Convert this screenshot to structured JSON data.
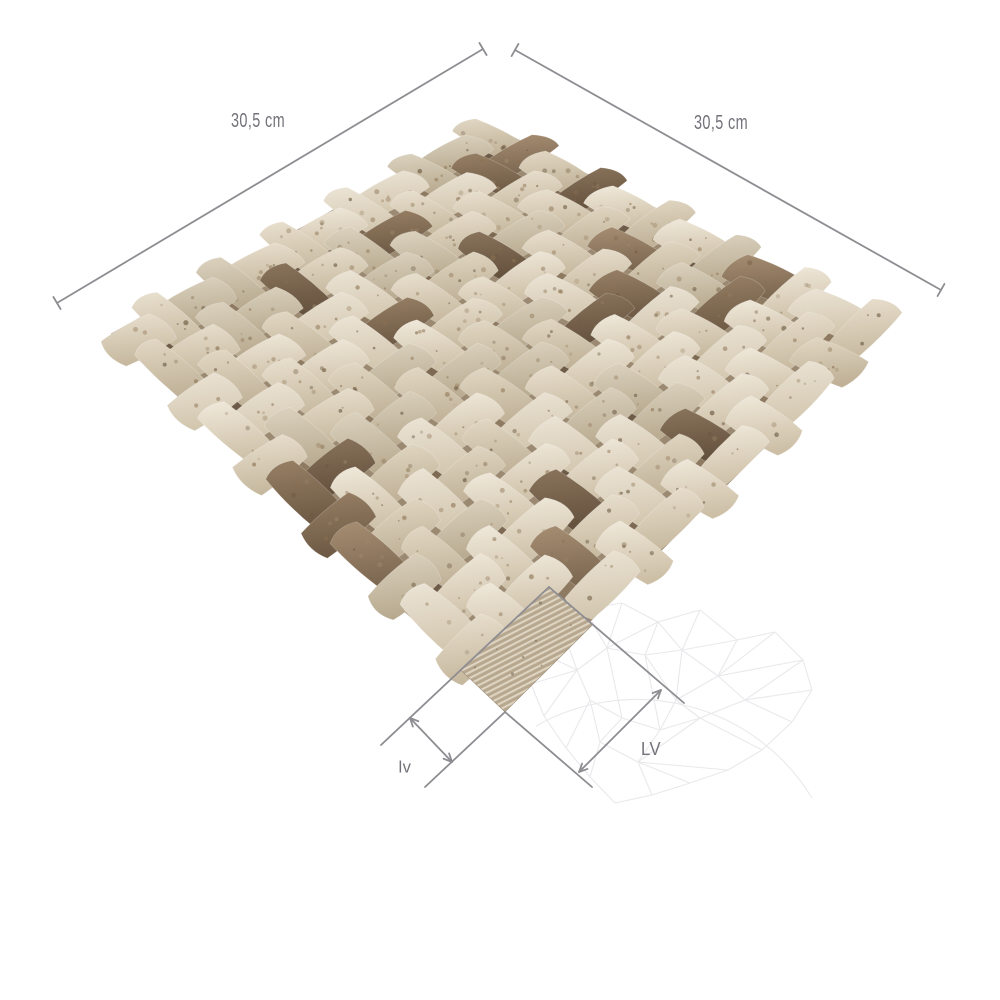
{
  "page": {
    "bg": "#ffffff"
  },
  "product": {
    "name": "travertine-3d-basket-weave-mosaic",
    "description": "Beige and noce travertine arched basket-weave mosaic tile shown in diamond orientation, one corner chip removed to expose the striped mesh backing"
  },
  "dimensions": {
    "line_color": "#8e8d92",
    "label_color": "#737179",
    "top_left": {
      "label": "30,5 cm",
      "from": [
        57,
        303
      ],
      "to": [
        483,
        49
      ],
      "label_pos": [
        258,
        121
      ],
      "font_size": 20,
      "text_length": 54
    },
    "top_right": {
      "label": "30,5 cm",
      "from": [
        515,
        50
      ],
      "to": [
        941,
        290
      ],
      "label_pos": [
        721,
        123
      ],
      "font_size": 20,
      "text_length": 54
    },
    "chip_width": {
      "label": "lv",
      "ext_a": [
        [
          549,
          587
        ],
        [
          381,
          745
        ]
      ],
      "ext_b": [
        [
          505,
          712
        ],
        [
          425,
          787
        ]
      ],
      "arrow": [
        [
          410,
          718
        ],
        [
          452,
          762
        ]
      ],
      "label_pos": [
        405,
        767
      ],
      "font_size": 17,
      "text_length": 13
    },
    "chip_length": {
      "label": "LV",
      "ext_a": [
        [
          549,
          587
        ],
        [
          684,
          703
        ]
      ],
      "ext_b": [
        [
          505,
          712
        ],
        [
          592,
          787
        ]
      ],
      "arrow": [
        [
          579,
          772
        ],
        [
          661,
          690
        ]
      ],
      "label_pos": [
        651,
        749
      ],
      "font_size": 18,
      "text_length": 20
    }
  },
  "tile": {
    "corners": {
      "top": [
        487,
        120
      ],
      "right": [
        895,
        323
      ],
      "bottom": [
        505,
        712
      ],
      "left": [
        105,
        333
      ]
    },
    "grid": 12,
    "seed": 7,
    "base_color": "#9b8a71",
    "under_colors": [
      "#6d5a46",
      "#7c6850",
      "#8d7960"
    ],
    "cream_gradients": [
      [
        "#f0e9db",
        "#cdbfa6"
      ],
      [
        "#e9e0cf",
        "#c6b89e"
      ],
      [
        "#e2d8c4",
        "#bfb096"
      ],
      [
        "#ece4d6",
        "#d2c6ae"
      ],
      [
        "#dcd3c0",
        "#b7a98e"
      ]
    ],
    "brown_gradients": [
      [
        "#a68e72",
        "#7b6650"
      ],
      [
        "#978065",
        "#6d5944"
      ],
      [
        "#8a745c",
        "#63503c"
      ]
    ],
    "brown_ratio": 0.1,
    "speckle_colors": [
      "#8a7050",
      "#6b583f",
      "#9b8668"
    ],
    "mesh_patch": {
      "u_range": [
        0.89,
        1
      ],
      "v_range": [
        0.775,
        1
      ],
      "fill": "#b7a78f",
      "stripe": "#ded4c2",
      "stripe_angle": -27,
      "stripe_spacing": 5.2,
      "stripe_width": 2.2,
      "speckle": "#6e5c49"
    }
  },
  "watermark": {
    "color": "#e9e9ec",
    "stroke_width": 1.1,
    "arc": "M 536 726 A 205 205 0 0 1 812 798",
    "nodes": [
      [
        585,
        609
      ],
      [
        622,
        603
      ],
      [
        658,
        622
      ],
      [
        700,
        610
      ],
      [
        737,
        640
      ],
      [
        775,
        632
      ],
      [
        803,
        660
      ],
      [
        812,
        690
      ],
      [
        792,
        722
      ],
      [
        762,
        750
      ],
      [
        728,
        770
      ],
      [
        690,
        783
      ],
      [
        652,
        795
      ],
      [
        615,
        803
      ],
      [
        590,
        777
      ],
      [
        566,
        748
      ],
      [
        544,
        716
      ],
      [
        531,
        684
      ],
      [
        542,
        653
      ],
      [
        562,
        629
      ],
      [
        607,
        648
      ],
      [
        645,
        655
      ],
      [
        682,
        650
      ],
      [
        718,
        676
      ],
      [
        745,
        700
      ],
      [
        700,
        718
      ],
      [
        660,
        730
      ],
      [
        622,
        718
      ],
      [
        590,
        700
      ],
      [
        638,
        762
      ],
      [
        600,
        742
      ],
      [
        676,
        700
      ],
      [
        577,
        670
      ]
    ],
    "segments": [
      [
        0,
        1
      ],
      [
        1,
        2
      ],
      [
        2,
        3
      ],
      [
        3,
        4
      ],
      [
        4,
        5
      ],
      [
        5,
        6
      ],
      [
        6,
        7
      ],
      [
        7,
        8
      ],
      [
        8,
        9
      ],
      [
        9,
        10
      ],
      [
        10,
        11
      ],
      [
        11,
        12
      ],
      [
        12,
        13
      ],
      [
        13,
        14
      ],
      [
        14,
        15
      ],
      [
        15,
        16
      ],
      [
        16,
        17
      ],
      [
        17,
        18
      ],
      [
        18,
        19
      ],
      [
        19,
        0
      ],
      [
        0,
        20
      ],
      [
        1,
        20
      ],
      [
        2,
        20
      ],
      [
        2,
        21
      ],
      [
        20,
        21
      ],
      [
        2,
        22
      ],
      [
        3,
        22
      ],
      [
        4,
        22
      ],
      [
        21,
        22
      ],
      [
        4,
        23
      ],
      [
        5,
        23
      ],
      [
        6,
        23
      ],
      [
        22,
        23
      ],
      [
        23,
        24
      ],
      [
        6,
        24
      ],
      [
        7,
        24
      ],
      [
        8,
        24
      ],
      [
        23,
        31
      ],
      [
        24,
        25
      ],
      [
        31,
        25
      ],
      [
        22,
        31
      ],
      [
        31,
        26
      ],
      [
        25,
        26
      ],
      [
        21,
        26
      ],
      [
        26,
        27
      ],
      [
        20,
        27
      ],
      [
        27,
        28
      ],
      [
        28,
        32
      ],
      [
        16,
        32
      ],
      [
        17,
        32
      ],
      [
        18,
        32
      ],
      [
        19,
        32
      ],
      [
        20,
        32
      ],
      [
        15,
        28
      ],
      [
        27,
        30
      ],
      [
        28,
        30
      ],
      [
        30,
        29
      ],
      [
        26,
        29
      ],
      [
        29,
        12
      ],
      [
        29,
        11
      ],
      [
        25,
        29
      ],
      [
        9,
        25
      ],
      [
        10,
        29
      ],
      [
        14,
        30
      ],
      [
        21,
        31
      ]
    ]
  }
}
